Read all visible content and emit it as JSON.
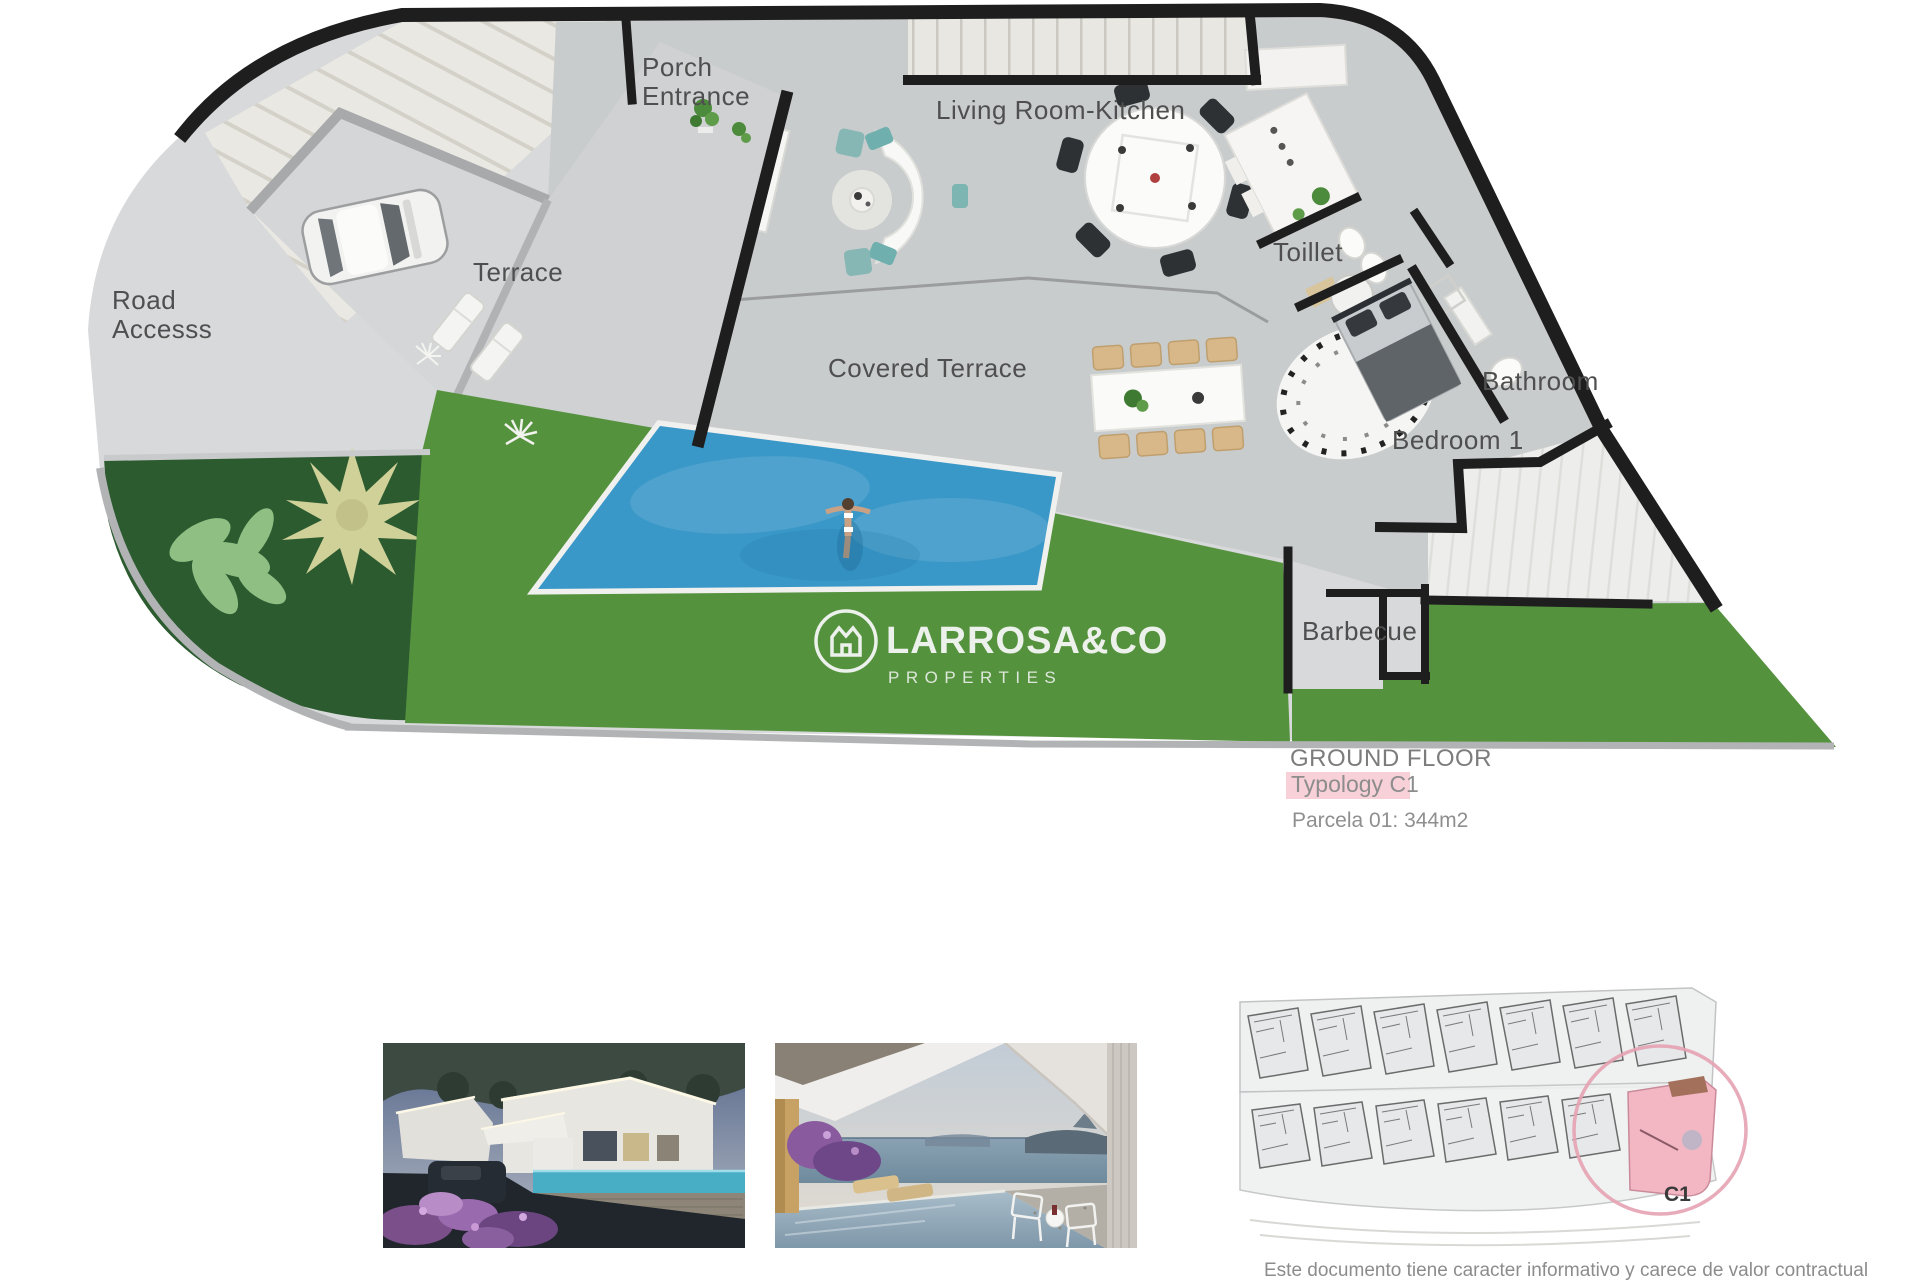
{
  "document": {
    "plan": {
      "labels": {
        "porch_line1": "Porch",
        "porch_line2": "Entrance",
        "living": "Living Room-Kitchen",
        "terrace": "Terrace",
        "road_line1": "Road",
        "road_line2": "Accesss",
        "covered": "Covered Terrace",
        "toilet": "Toillet",
        "bathroom": "Bathroom",
        "bedroom": "Bedroom 1",
        "barbecue": "Barbecue"
      },
      "logo": {
        "name": "LARROSA&CO",
        "tagline": "PROPERTIES"
      }
    },
    "title_block": {
      "floor": "GROUND FLOOR",
      "typology": "Typology C1",
      "parcel": "Parcela 01: 344m2"
    },
    "site_plan": {
      "unit": "C1"
    },
    "disclaimer": "Este documento tiene caracter informativo y carece de valor contractual",
    "colors": {
      "paving": "#d8d9da",
      "floor": "#c9cccd",
      "grass": "#55923e",
      "garden": "#2c5b30",
      "pool": "#3a98c8",
      "wall": "#1e1e1e",
      "label": "#4f4f4f",
      "highlight_pink": "#f7d0d8",
      "site_pink": "#f3b7c4",
      "logo": "#edf1ec"
    }
  }
}
